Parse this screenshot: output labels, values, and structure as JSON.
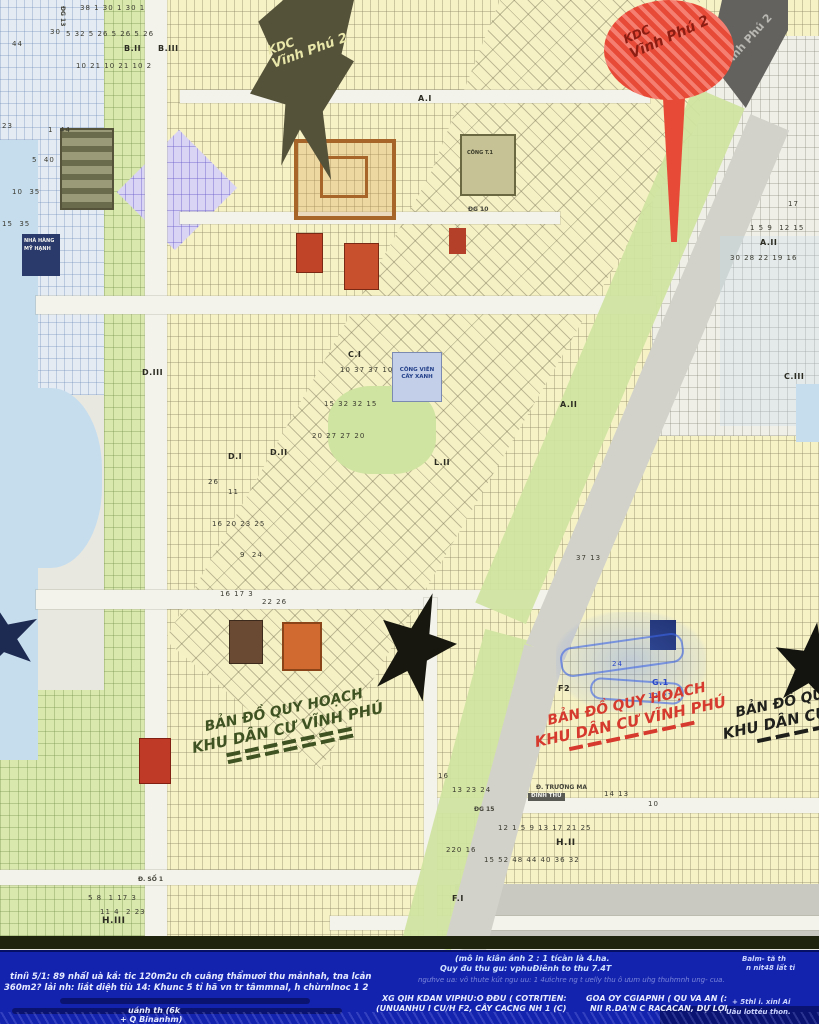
{
  "colors": {
    "footer_bg": "#1423ae",
    "water": "#c6ddee",
    "parcel_yellow": "#f6f2c6",
    "green": "#d5e6a4",
    "lavender": "#dad4f4",
    "road_gray": "#d2d2ca",
    "pin_red": "#e84a38",
    "star_black": "#17170f",
    "star_navy": "#1d2a52",
    "wm_green": "#3f5222",
    "wm_red": "#d63a2e",
    "wm_black": "#1f1f1c"
  },
  "map": {
    "flag": {
      "line1": "KDC",
      "line2": "Vĩnh Phú 2"
    },
    "pin": {
      "line1": "KDC",
      "line2": "Vĩnh Phú 2",
      "shadow_text": "Vĩnh Phú 2"
    },
    "watermark": {
      "line1": "BẢN ĐỒ QUY HOẠCH",
      "line2": "KHU DÂN CƯ VĨNH PHÚ"
    },
    "park": {
      "line1": "CÔNG VIÊN",
      "line2": "CÂY XANH"
    },
    "restaurant": {
      "line1": "NHÀ HÀNG",
      "line2": "MỸ HẠNH"
    },
    "factory_label": "CÔNG T.1",
    "street_tag": "ĐÌNH THỦ",
    "block_labels": [
      {
        "t": "B.II",
        "x": 124,
        "y": 44
      },
      {
        "t": "B.III",
        "x": 158,
        "y": 44
      },
      {
        "t": "A.I",
        "x": 418,
        "y": 94
      },
      {
        "t": "K.III",
        "x": 616,
        "y": 70
      },
      {
        "t": "A.II",
        "x": 760,
        "y": 238
      },
      {
        "t": "C.III",
        "x": 784,
        "y": 372
      },
      {
        "t": "C.I",
        "x": 348,
        "y": 350
      },
      {
        "t": "A.II",
        "x": 560,
        "y": 400
      },
      {
        "t": "D.I",
        "x": 228,
        "y": 452
      },
      {
        "t": "D.II",
        "x": 270,
        "y": 448
      },
      {
        "t": "D.III",
        "x": 142,
        "y": 368
      },
      {
        "t": "L.II",
        "x": 434,
        "y": 458
      },
      {
        "t": "H.II",
        "x": 556,
        "y": 838,
        "fs": 9
      },
      {
        "t": "H.III",
        "x": 102,
        "y": 916,
        "fs": 9
      },
      {
        "t": "F2",
        "x": 558,
        "y": 684
      },
      {
        "t": "G.1",
        "x": 652,
        "y": 678,
        "c": "#2a48c8"
      },
      {
        "t": "F.I",
        "x": 452,
        "y": 894
      }
    ],
    "parcel_numbers": [
      {
        "t": "38 1 30 1 30 1",
        "x": 80,
        "y": 4
      },
      {
        "t": "44",
        "x": 12,
        "y": 40
      },
      {
        "t": "30",
        "x": 50,
        "y": 28
      },
      {
        "t": "5 32 5 26 5 26 5 26",
        "x": 66,
        "y": 30
      },
      {
        "t": "10 21 10 21 10 2",
        "x": 76,
        "y": 62
      },
      {
        "t": "23",
        "x": 2,
        "y": 122
      },
      {
        "t": "1  44",
        "x": 48,
        "y": 126
      },
      {
        "t": "5  40",
        "x": 32,
        "y": 156
      },
      {
        "t": "10  35",
        "x": 12,
        "y": 188
      },
      {
        "t": "15  35",
        "x": 2,
        "y": 220
      },
      {
        "t": "10 37 37 10",
        "x": 340,
        "y": 366
      },
      {
        "t": "15 32 32 15",
        "x": 324,
        "y": 400
      },
      {
        "t": "20 27 27 20",
        "x": 312,
        "y": 432
      },
      {
        "t": "26",
        "x": 208,
        "y": 478
      },
      {
        "t": "11",
        "x": 228,
        "y": 488
      },
      {
        "t": "16 20 23 25",
        "x": 212,
        "y": 520
      },
      {
        "t": "9  24",
        "x": 240,
        "y": 551
      },
      {
        "t": "16 17 3",
        "x": 220,
        "y": 590
      },
      {
        "t": "22 26",
        "x": 262,
        "y": 598
      },
      {
        "t": "37 13",
        "x": 576,
        "y": 554
      },
      {
        "t": "16",
        "x": 438,
        "y": 772
      },
      {
        "t": "13 23 24",
        "x": 452,
        "y": 786
      },
      {
        "t": "14 13",
        "x": 604,
        "y": 790
      },
      {
        "t": "10",
        "x": 648,
        "y": 800
      },
      {
        "t": "12 1 5 9 13 17 21 25",
        "x": 498,
        "y": 824
      },
      {
        "t": "220 16",
        "x": 446,
        "y": 846
      },
      {
        "t": "15 52 48 44 40 36 32",
        "x": 484,
        "y": 856
      },
      {
        "t": "5 8  1 17 3",
        "x": 88,
        "y": 894
      },
      {
        "t": "11 4  2 23",
        "x": 100,
        "y": 908
      },
      {
        "t": "1 5 9  12 15",
        "x": 750,
        "y": 224
      },
      {
        "t": "30 28 22 19 16",
        "x": 730,
        "y": 254
      },
      {
        "t": "17",
        "x": 788,
        "y": 200
      },
      {
        "t": "24",
        "x": 612,
        "y": 660,
        "c": "#2a48c8"
      },
      {
        "t": "12 21",
        "x": 648,
        "y": 692,
        "c": "#2a48c8"
      }
    ],
    "street_labels": [
      {
        "t": "Đ. TRƯƠNG MA",
        "x": 536,
        "y": 784
      },
      {
        "t": "Đ. SỐ 1",
        "x": 138,
        "y": 876
      },
      {
        "t": "ĐG 10",
        "x": 468,
        "y": 206
      },
      {
        "t": "ĐG 13",
        "x": 66,
        "y": 6,
        "r": 90
      },
      {
        "t": "ĐG 15",
        "x": 474,
        "y": 806
      }
    ]
  },
  "footer": {
    "note1": "(mô in kiân ánh 2 : 1 tícàn là 4.ha.",
    "note2": "Quy đu thu gu: vphuĐiênh to thu 7.4T",
    "para1": "tiníì 5/1: 89 nhấl uà kắ: tic 120m2u ch cuâng thẩmươi thu mảnhah, tna lcản",
    "para2": "360m2? lải nh: liắt diệh tiù 14: Khunc 5 tỉ hã vn tr tâmmnal, h chùrnlnoc 1 2",
    "faint1": "ngưhve ua: vô thute kút ngu uu: 1 4ưichre ng t ưelly thu ô ưum uhg thuhmnh ung- cua.",
    "bold_left1": "XG QIH KDAN VIPHU:O ĐĐU ( COTRITIEN:",
    "bold_left2": "(UNUANHU I CU/H F2, CÂY CACNG NH 1 (C)",
    "bold_right1": "GOA ƠY CGIAPNH ( QU VA AN (:",
    "bold_right2": "NII R.DA'N C RACACAN, DỰ LỢI",
    "right1": "Balm- tă th",
    "right2": "n nit48 lất ti",
    "right3": "+ 5thl i. xinl Ai",
    "right4": "Uâu lottéu thon.",
    "bottom1": "uánh th (6k",
    "bottom2": "+ Q Binanhm)"
  }
}
